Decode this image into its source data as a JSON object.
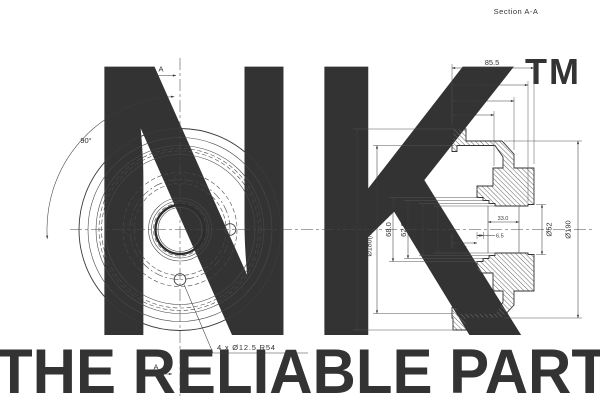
{
  "page": {
    "section_label": "Section A-A"
  },
  "watermark": {
    "logo": "NK",
    "tm": "TM",
    "tagline": "THE RELIABLE PART",
    "logo_color": "#dcdcdc",
    "tagline_color": "#cfcfcf"
  },
  "front_view": {
    "cut_a_top": "A",
    "cut_a_bottom": "A",
    "angle": "90°",
    "holes_note": "4 x Ø12.5 R54"
  },
  "section_view": {
    "dims": {
      "w855": "85.5",
      "w76": "76",
      "w63": "63",
      "w44": "44",
      "d216": "Ø216",
      "d180": "Ø180(Max Ø181)",
      "d68": "68.0",
      "d62": "62.0",
      "d55": "55.0",
      "d502": "Ø50.2",
      "l33": "33.0",
      "l65": "6.5",
      "l255": "25.5",
      "d52": "Ø52",
      "d190": "Ø190"
    }
  }
}
